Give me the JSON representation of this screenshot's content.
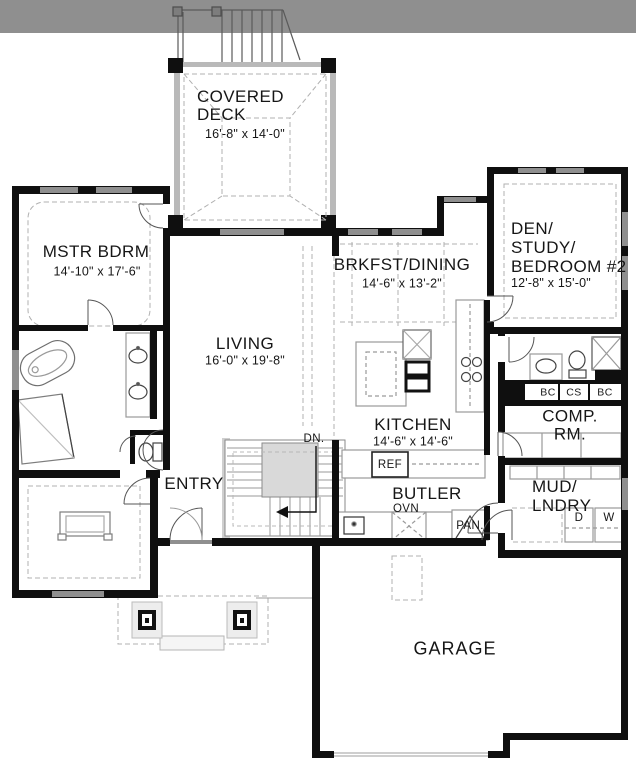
{
  "meta": {
    "type": "architectural-floor-plan",
    "floor": "main level"
  },
  "colors": {
    "wall": "#0f0f0f",
    "window": "#8f8f8f",
    "photo_band": "#8f8f8f",
    "light_line": "#9c9c9c",
    "paper": "#ffffff"
  },
  "rooms": {
    "covered_deck": {
      "label": "COVERED\nDECK",
      "dims": "16'-8\" x 14'-0\""
    },
    "mstr_bdrm": {
      "label": "MSTR BDRM",
      "dims": "14'-10\" x 17'-6\""
    },
    "brkfst_dining": {
      "label": "BRKFST/DINING",
      "dims": "14'-6\" x 13'-2\""
    },
    "den_study": {
      "label": "DEN/\nSTUDY/\nBEDROOM #2",
      "dims": "12'-8\" x 15'-0\""
    },
    "living": {
      "label": "LIVING",
      "dims": "16'-0\" x 19'-8\""
    },
    "kitchen": {
      "label": "KITCHEN",
      "dims": "14'-6\" x 14'-6\""
    },
    "comp_rm": {
      "label": "COMP. RM."
    },
    "mud_lndry": {
      "label": "MUD/\nLNDRY"
    },
    "entry": {
      "label": "ENTRY"
    },
    "butler": {
      "label": "BUTLER"
    },
    "garage": {
      "label": "GARAGE"
    }
  },
  "annotations": {
    "dn": "DN.",
    "ref": "REF",
    "ovn": "OVN",
    "pan": "PAN.",
    "dryer": "D",
    "washer": "W",
    "cab_bc_left": "BC",
    "cab_cs": "CS",
    "cab_bc_right": "BC"
  }
}
